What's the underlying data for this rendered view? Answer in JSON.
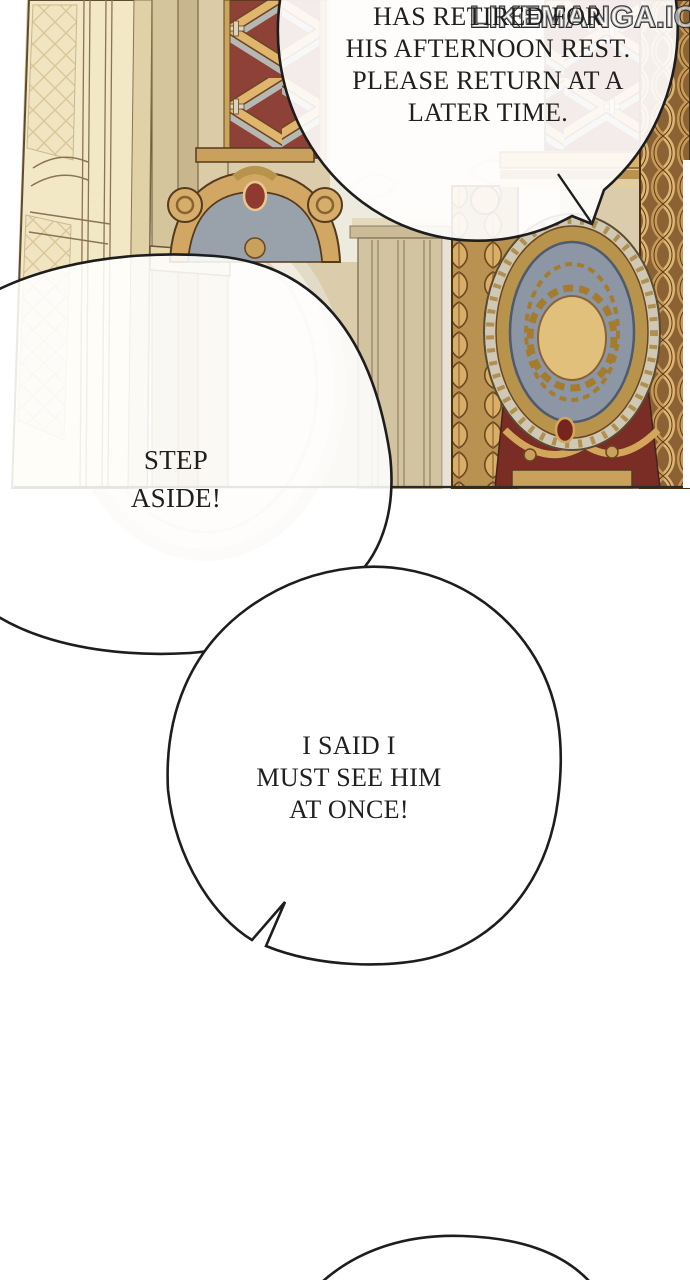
{
  "page": {
    "bg": "#ffffff"
  },
  "watermark": {
    "text": "LIKEMANGA.IO"
  },
  "bubbles": {
    "announcement": {
      "lines": [
        "HAS RETIRED FOR",
        "HIS AFTERNOON REST.",
        "PLEASE RETURN AT A",
        "LATER TIME."
      ]
    },
    "step_aside": {
      "lines": [
        "STEP",
        "ASIDE!"
      ]
    },
    "insist": {
      "lines": [
        "I SAID I",
        "MUST SEE HIM",
        "AT ONCE!"
      ]
    }
  },
  "artwork": {
    "colors": {
      "outline": "#1d1d1d",
      "wall": "#dbcdab",
      "wall_pale": "#edeade",
      "door": "#f2e8c6",
      "casing": "#d5c59c",
      "gold": "#c99f5c",
      "gold_light": "#e0b66f",
      "gold_dark": "#8a6234",
      "lattice_red": "#8e4136",
      "drape_red": "#7a2d24",
      "oval_blue": "#8c96a5",
      "medallion_gold": "#e0c07a",
      "ribbon_gray": "#b6b8b4"
    }
  }
}
